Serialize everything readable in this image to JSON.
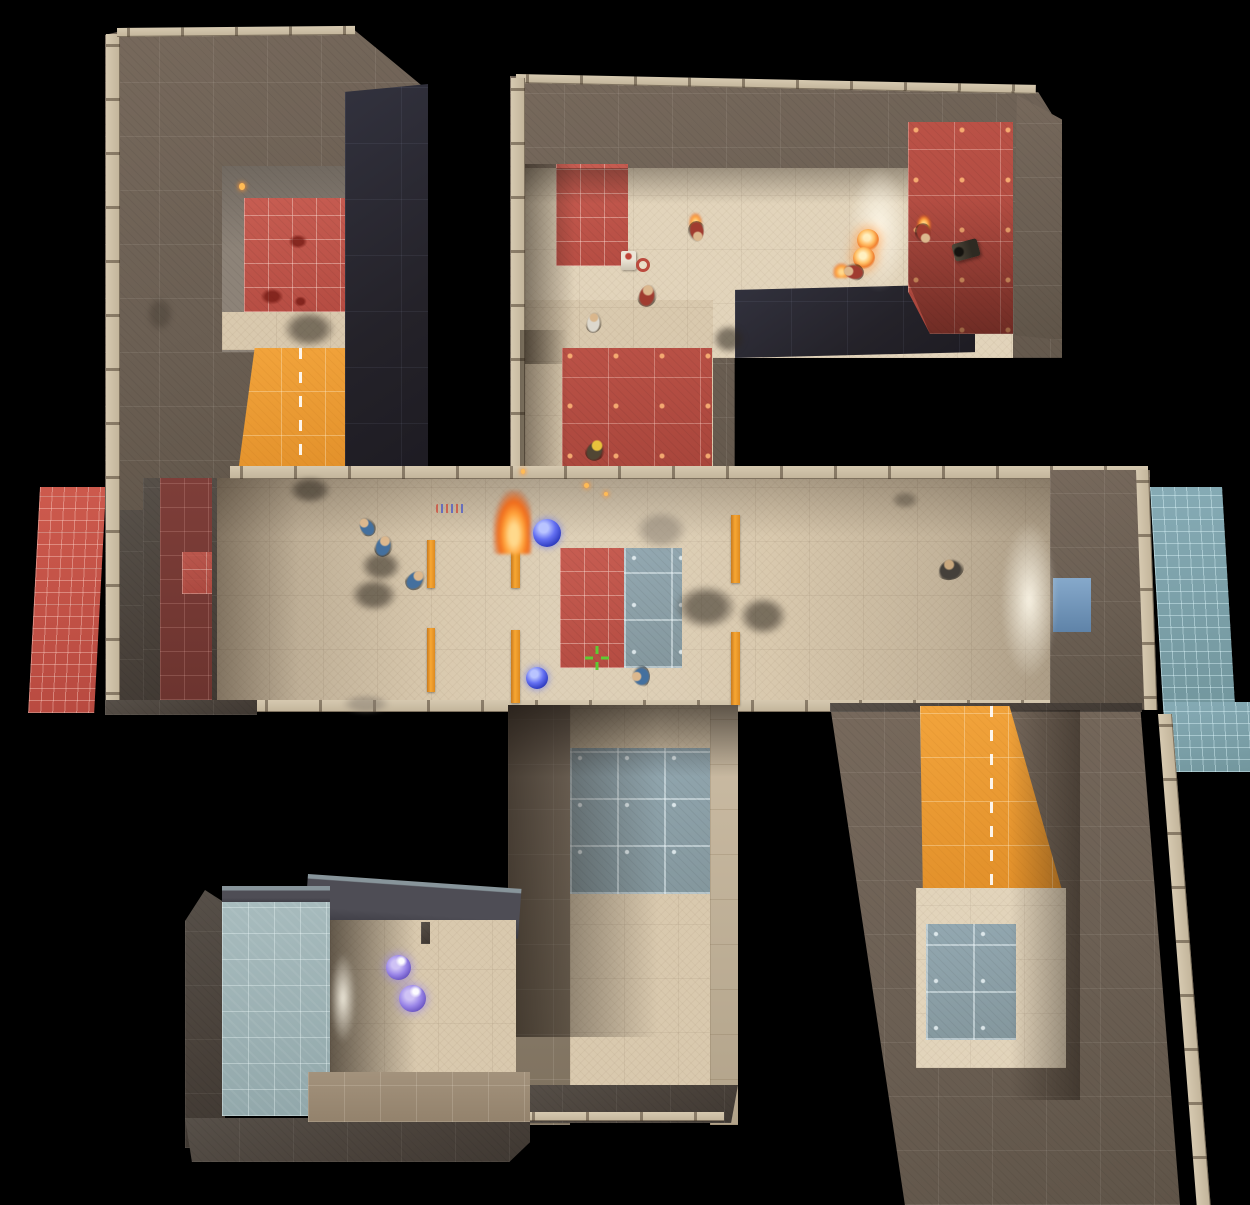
{
  "meta": {
    "width": 1250,
    "height": 1205,
    "background": "#000000",
    "scene": "top-down overhead view of four-arm pinwheel arena map with central corridor"
  },
  "palette": {
    "wall_brown": "#6e6356",
    "wall_dark": "#4c443c",
    "wall_navy": "#26242d",
    "floor_tan": "#d9c9ae",
    "red_tile": "#c05a50",
    "slate_tile": "#8da2ab",
    "blue_pad": "#7ea6b0",
    "orange_ramp": "#ec9c33",
    "crosshair_green": "#5ecb34",
    "orb_blue": "#6470f2",
    "orb_purple": "#9a86e8",
    "fireball_orange": "#ffc066"
  },
  "hud": {
    "crosshair": {
      "x": 585,
      "y": 646,
      "color": "#5ecb34"
    }
  },
  "entities": [
    {
      "name": "ext-pad-red-left",
      "cls": "tile-red-fine",
      "x": 40,
      "y": 487,
      "w": 66,
      "h": 226,
      "tr": "skewX(-3deg)"
    },
    {
      "name": "ext-pad-blue-right",
      "cls": "tile-blue-fine",
      "x": 1150,
      "y": 487,
      "w": 72,
      "h": 225,
      "tr": "skewX(3.4deg)"
    },
    {
      "name": "ext-pad-blue-right-lower",
      "cls": "tile-blue-fine",
      "x": 1163,
      "y": 702,
      "w": 90,
      "h": 70,
      "tr": "skewX(3.4deg)"
    },
    {
      "name": "topleft-arm-roof",
      "cls": "wall",
      "x": 105,
      "y": 28,
      "w": 322,
      "h": 487,
      "clip": "polygon(4% 0.8%,76.7% 0%,100% 12.7%,100% 100%,0% 100%,0% 1.4%)"
    },
    {
      "name": "topleft-arm-west-wall",
      "cls": "wall-dark",
      "x": 105,
      "y": 510,
      "w": 112,
      "h": 204,
      "clip": "polygon(0 0,100% 0,100% 94%,28% 100%,0 97%)"
    },
    {
      "name": "topleft-tick-west",
      "cls": "tickv",
      "x": 106,
      "y": 34,
      "w": 14,
      "h": 672
    },
    {
      "name": "topleft-tick-top",
      "cls": "tickh",
      "x": 117,
      "y": 28,
      "w": 238,
      "h": 9,
      "tr": "rotate(-0.5deg)"
    },
    {
      "name": "topleft-room-grey-floor",
      "cls": "floor-grey",
      "x": 222,
      "y": 166,
      "w": 123,
      "h": 186
    },
    {
      "name": "topleft-room-red-tiles",
      "cls": "tile-red-room",
      "x": 244,
      "y": 198,
      "w": 101,
      "h": 114
    },
    {
      "name": "topleft-tan-strip",
      "cls": "floor-tan",
      "x": 222,
      "y": 312,
      "w": 123,
      "h": 38
    },
    {
      "name": "topleft-orange-ramp",
      "cls": "ramp",
      "x": 237,
      "y": 348,
      "w": 126,
      "h": 132,
      "clip": "polygon(14% 0,86% 0,100% 100%,0 100%)"
    },
    {
      "name": "topleft-navy-wall",
      "cls": "wall-navy",
      "x": 345,
      "y": 84,
      "w": 83,
      "h": 396,
      "clip": "polygon(0 2%,100% 0,100% 98%,0 100%)"
    },
    {
      "name": "topright-arm-roof",
      "cls": "wall",
      "x": 510,
      "y": 70,
      "w": 552,
      "h": 402,
      "clip": "polygon(0 1.5%,95.7% 5.5%,100% 15%,100% 71.6%,40.7% 71.6%,40.7% 100%,0 100%)"
    },
    {
      "name": "topright-tick-top",
      "cls": "tickh",
      "x": 516,
      "y": 74,
      "w": 520,
      "h": 9,
      "tr": "rotate(1.2deg)"
    },
    {
      "name": "topright-tick-west",
      "cls": "tickv",
      "x": 511,
      "y": 78,
      "w": 14,
      "h": 392
    },
    {
      "name": "topright-floor-main",
      "cls": "floor-tan-bright",
      "x": 525,
      "y": 168,
      "w": 488,
      "h": 190
    },
    {
      "name": "topright-floor-leg",
      "cls": "floor-tan",
      "x": 525,
      "y": 300,
      "w": 188,
      "h": 170
    },
    {
      "name": "topright-red-wall-strip",
      "cls": "tile-red-room",
      "x": 556,
      "y": 164,
      "w": 72,
      "h": 102
    },
    {
      "name": "topright-shade-left-upper",
      "cls": "shade-v",
      "x": 525,
      "y": 164,
      "w": 50,
      "h": 200
    },
    {
      "name": "topright-red-floor-leg",
      "cls": "tile-red-big",
      "x": 562,
      "y": 348,
      "w": 150,
      "h": 122
    },
    {
      "name": "topright-shade-left-leg",
      "cls": "shade-v",
      "x": 520,
      "y": 330,
      "w": 48,
      "h": 140
    },
    {
      "name": "topright-floor-top-shade",
      "cls": "shade-top",
      "x": 525,
      "y": 168,
      "w": 488,
      "h": 36
    },
    {
      "name": "topright-navy-block",
      "cls": "wall-navy",
      "x": 735,
      "y": 284,
      "w": 240,
      "h": 74,
      "clip": "polygon(0 8%,100% 0,100% 92%,0 100%)"
    },
    {
      "name": "topright-red-room",
      "cls": "tile-red-big",
      "x": 908,
      "y": 122,
      "w": 105,
      "h": 212,
      "clip": "polygon(0 0,100% 0,100% 100%,21% 100%,0 80%)"
    },
    {
      "name": "topright-red-room-shade",
      "cls": "shade-b",
      "x": 908,
      "y": 200,
      "w": 105,
      "h": 134,
      "clip": "polygon(0 0,100% 0,100% 100%,21% 100%,0 61%)"
    },
    {
      "name": "topright-side-wall",
      "cls": "wall",
      "x": 1013,
      "y": 95,
      "w": 49,
      "h": 245,
      "clip": "polygon(8% 0,100% 10%,100% 100%,0 98%)"
    },
    {
      "name": "topright-doorway-glow",
      "cls": "glow",
      "x": 848,
      "y": 166,
      "w": 62,
      "h": 126
    },
    {
      "name": "corridor-floor",
      "cls": "floor-tan",
      "x": 215,
      "y": 478,
      "w": 840,
      "h": 226
    },
    {
      "name": "corridor-lighting",
      "cls": "shade-cor",
      "x": 215,
      "y": 478,
      "w": 840,
      "h": 226
    },
    {
      "name": "corridor-top-tick",
      "cls": "tickh",
      "x": 230,
      "y": 466,
      "w": 918,
      "h": 13
    },
    {
      "name": "corridor-west-wall",
      "cls": "wall-dark",
      "x": 143,
      "y": 478,
      "w": 74,
      "h": 226
    },
    {
      "name": "corridor-west-red-stripe",
      "cls": "tile-red-dark",
      "x": 160,
      "y": 478,
      "w": 52,
      "h": 222
    },
    {
      "name": "corridor-west-red-patch",
      "cls": "tile-red-room",
      "x": 182,
      "y": 552,
      "w": 30,
      "h": 42,
      "o": 0.85
    },
    {
      "name": "corridor-east-wall",
      "cls": "wall",
      "x": 1050,
      "y": 470,
      "w": 100,
      "h": 240,
      "clip": "polygon(0 0,100% 0,100% 100%,0 98%)"
    },
    {
      "name": "corridor-east-tick",
      "cls": "tickv",
      "x": 1136,
      "y": 470,
      "w": 13,
      "h": 240,
      "tr": "skewX(2deg)"
    },
    {
      "name": "corridor-east-blue-door",
      "cls": "door-blue",
      "x": 1053,
      "y": 578,
      "w": 38,
      "h": 54
    },
    {
      "name": "corridor-east-glow",
      "cls": "glow",
      "x": 1000,
      "y": 520,
      "w": 58,
      "h": 160
    },
    {
      "name": "corridor-bottom-tick",
      "cls": "tickh",
      "x": 255,
      "y": 700,
      "w": 795,
      "h": 12
    },
    {
      "name": "corridor-bottom-dark-left",
      "cls": "wall-dark",
      "x": 105,
      "y": 700,
      "w": 152,
      "h": 15
    },
    {
      "name": "corridor-red-square",
      "cls": "tile-red-room",
      "x": 560,
      "y": 548,
      "w": 64,
      "h": 120
    },
    {
      "name": "corridor-slate-square",
      "cls": "tile-slate",
      "x": 624,
      "y": 548,
      "w": 58,
      "h": 120
    },
    {
      "name": "door-pillar-a-upper",
      "cls": "pillar",
      "x": 427,
      "y": 540,
      "w": 8,
      "h": 48
    },
    {
      "name": "door-pillar-a-lower",
      "cls": "pillar",
      "x": 427,
      "y": 628,
      "w": 8,
      "h": 64
    },
    {
      "name": "door-pillar-b-upper",
      "cls": "pillar",
      "x": 511,
      "y": 548,
      "w": 9,
      "h": 40
    },
    {
      "name": "door-pillar-b-lower",
      "cls": "pillar",
      "x": 511,
      "y": 630,
      "w": 9,
      "h": 73
    },
    {
      "name": "door-pillar-c-upper",
      "cls": "pillar",
      "x": 731,
      "y": 515,
      "w": 9,
      "h": 68
    },
    {
      "name": "door-pillar-c-lower",
      "cls": "pillar",
      "x": 731,
      "y": 632,
      "w": 9,
      "h": 73
    },
    {
      "name": "bottommid-left-wall",
      "cls": "wall-khaki",
      "x": 508,
      "y": 705,
      "w": 62,
      "h": 420
    },
    {
      "name": "bottommid-right-wall",
      "cls": "wall-khaki-light",
      "x": 710,
      "y": 705,
      "w": 28,
      "h": 420
    },
    {
      "name": "bottommid-floor",
      "cls": "floor-tan",
      "x": 570,
      "y": 705,
      "w": 140,
      "h": 382
    },
    {
      "name": "bottommid-slate-tiles",
      "cls": "tile-slate",
      "x": 570,
      "y": 748,
      "w": 140,
      "h": 146
    },
    {
      "name": "bottommid-door-shadow",
      "cls": "shade-top-strong",
      "x": 508,
      "y": 705,
      "w": 230,
      "h": 72
    },
    {
      "name": "bottommid-left-shade",
      "cls": "shade-v-strong",
      "x": 508,
      "y": 705,
      "w": 150,
      "h": 332
    },
    {
      "name": "bottommid-bottom-wall",
      "cls": "wall-dark",
      "x": 508,
      "y": 1085,
      "w": 230,
      "h": 38,
      "clip": "polygon(0 0,100% 0,97% 100%,3% 100%)"
    },
    {
      "name": "bottommid-bottom-tick",
      "cls": "tickh",
      "x": 522,
      "y": 1112,
      "w": 202,
      "h": 9
    },
    {
      "name": "bottomleft-roof-strip",
      "cls": "roof-slate",
      "x": 308,
      "y": 874,
      "w": 214,
      "h": 50,
      "tr": "rotate(4deg)"
    },
    {
      "name": "bottomleft-left-wall",
      "cls": "wall-dark",
      "x": 185,
      "y": 890,
      "w": 40,
      "h": 258,
      "clip": "polygon(0 12%,50% 0,100% 5%,100% 100%,0 100%)"
    },
    {
      "name": "bottomleft-bottom-wall",
      "cls": "wall-dark",
      "x": 185,
      "y": 1118,
      "w": 345,
      "h": 44,
      "clip": "polygon(0 0,100% 0,100% 55%,94% 100%,2% 100%)"
    },
    {
      "name": "bottomleft-pool-top-face",
      "cls": "roof-slate",
      "x": 222,
      "y": 886,
      "w": 108,
      "h": 18
    },
    {
      "name": "bottomleft-pool-blue",
      "cls": "pool-blue",
      "x": 222,
      "y": 902,
      "w": 108,
      "h": 214
    },
    {
      "name": "bottomleft-floor",
      "cls": "floor-tan",
      "x": 330,
      "y": 920,
      "w": 186,
      "h": 158
    },
    {
      "name": "bottomleft-left-shade",
      "cls": "shade-v-strong",
      "x": 330,
      "y": 920,
      "w": 86,
      "h": 158
    },
    {
      "name": "bottomleft-door-glow",
      "cls": "glow",
      "x": 330,
      "y": 952,
      "w": 26,
      "h": 92
    },
    {
      "name": "bottomleft-tile-floor",
      "cls": "floor-tiles-brown",
      "x": 308,
      "y": 1072,
      "w": 222,
      "h": 50
    },
    {
      "name": "bottomleft-wall-stub",
      "cls": "wall-dark",
      "x": 421,
      "y": 922,
      "w": 9,
      "h": 22
    },
    {
      "name": "bottomright-arm-base",
      "cls": "wall",
      "x": 830,
      "y": 705,
      "w": 350,
      "h": 500,
      "clip": "polygon(0 0,88.6% 0,100% 100%,21.4% 100%)"
    },
    {
      "name": "bottomright-top-edge",
      "cls": "wall-dark",
      "x": 830,
      "y": 703,
      "w": 312,
      "h": 9
    },
    {
      "name": "bottomright-tick-east",
      "cls": "tickv",
      "x": 1158,
      "y": 714,
      "w": 14,
      "h": 491,
      "tr": "skewX(4.5deg)"
    },
    {
      "name": "bottomright-orange-ramp",
      "cls": "ramp",
      "x": 920,
      "y": 706,
      "w": 142,
      "h": 184,
      "clip": "polygon(0 0,63% 0,100% 100%,2% 100%)"
    },
    {
      "name": "bottomright-floor",
      "cls": "floor-tan-bright",
      "x": 916,
      "y": 888,
      "w": 150,
      "h": 180
    },
    {
      "name": "bottomright-slate-square",
      "cls": "tile-slate",
      "x": 926,
      "y": 924,
      "w": 90,
      "h": 116
    },
    {
      "name": "bottomright-right-shade",
      "cls": "shade-v-right",
      "x": 1010,
      "y": 710,
      "w": 70,
      "h": 390
    },
    {
      "name": "blood-decal-1",
      "cls": "decal-blood",
      "x": 288,
      "y": 234,
      "w": 20,
      "h": 15
    },
    {
      "name": "blood-decal-2",
      "cls": "decal-blood",
      "x": 260,
      "y": 288,
      "w": 24,
      "h": 17
    },
    {
      "name": "blood-decal-3",
      "cls": "decal-blood",
      "x": 294,
      "y": 296,
      "w": 13,
      "h": 11
    },
    {
      "name": "wall-scorch-decal",
      "cls": "smoke",
      "x": 146,
      "y": 296,
      "w": 28,
      "h": 36,
      "o": 0.5
    },
    {
      "name": "topleft-room-smoke",
      "cls": "smoke",
      "x": 282,
      "y": 310,
      "w": 54,
      "h": 38
    },
    {
      "name": "topleft-ramp-smoke",
      "cls": "smoke",
      "x": 288,
      "y": 476,
      "w": 44,
      "h": 28
    },
    {
      "name": "topleft-ember-spark",
      "cls": "ember",
      "x": 239,
      "y": 183,
      "w": 6,
      "h": 7
    },
    {
      "name": "navy-corner-smoke",
      "cls": "smoke",
      "x": 712,
      "y": 324,
      "w": 34,
      "h": 30
    },
    {
      "name": "corridor-smoke-1",
      "cls": "smoke",
      "x": 360,
      "y": 550,
      "w": 42,
      "h": 32
    },
    {
      "name": "corridor-smoke-2",
      "cls": "smoke",
      "x": 350,
      "y": 578,
      "w": 48,
      "h": 34
    },
    {
      "name": "corridor-smoke-3",
      "cls": "smoke",
      "x": 674,
      "y": 584,
      "w": 64,
      "h": 46
    },
    {
      "name": "corridor-smoke-4",
      "cls": "smoke",
      "x": 738,
      "y": 596,
      "w": 50,
      "h": 40
    },
    {
      "name": "corridor-smoke-light-1",
      "cls": "smoke-light",
      "x": 634,
      "y": 510,
      "w": 54,
      "h": 40
    },
    {
      "name": "corridor-smoke-light-2",
      "cls": "smoke-light",
      "x": 341,
      "y": 694,
      "w": 50,
      "h": 20
    },
    {
      "name": "corridor-gib-decal",
      "cls": "decal-confetti",
      "x": 436,
      "y": 504,
      "w": 30,
      "h": 9
    },
    {
      "name": "corridor-dark-decal",
      "cls": "smoke",
      "x": 891,
      "y": 491,
      "w": 28,
      "h": 18,
      "o": 0.65
    },
    {
      "name": "pillar-fire-flame",
      "cls": "fire",
      "x": 493,
      "y": 490,
      "w": 38,
      "h": 64
    },
    {
      "name": "fire-ember-1",
      "cls": "ember",
      "x": 584,
      "y": 483,
      "w": 5,
      "h": 5
    },
    {
      "name": "fire-ember-2",
      "cls": "ember",
      "x": 604,
      "y": 492,
      "w": 4,
      "h": 4
    },
    {
      "name": "fire-ember-3",
      "cls": "ember",
      "x": 521,
      "y": 469,
      "w": 4,
      "h": 5
    },
    {
      "name": "fireball-projectile-1",
      "cls": "orb-fire",
      "x": 857,
      "y": 229,
      "w": 22,
      "h": 22
    },
    {
      "name": "fireball-projectile-2",
      "cls": "orb-fire",
      "x": 853,
      "y": 247,
      "w": 22,
      "h": 22
    },
    {
      "name": "pyro-flame-trail",
      "cls": "fire-small",
      "x": 833,
      "y": 263,
      "w": 17,
      "h": 15
    },
    {
      "name": "burning-flame-1",
      "cls": "fire-small",
      "x": 917,
      "y": 215,
      "w": 14,
      "h": 17
    },
    {
      "name": "burning-flame-2",
      "cls": "fire-small",
      "x": 689,
      "y": 213,
      "w": 13,
      "h": 16
    },
    {
      "name": "blue-orb-projectile-1",
      "cls": "orb-blue",
      "x": 533,
      "y": 519,
      "w": 28,
      "h": 28
    },
    {
      "name": "blue-orb-projectile-2",
      "cls": "orb-blue",
      "x": 526,
      "y": 667,
      "w": 22,
      "h": 22
    },
    {
      "name": "purple-orb-projectile-1",
      "cls": "orb-purple",
      "x": 386,
      "y": 955,
      "w": 25,
      "h": 25
    },
    {
      "name": "purple-orb-projectile-2",
      "cls": "orb-purple",
      "x": 399,
      "y": 985,
      "w": 27,
      "h": 27
    },
    {
      "name": "player-blue-scout",
      "cls": "player p-blue",
      "x": 358,
      "y": 516,
      "w": 17,
      "h": 21,
      "tr": "rotate(-35deg)"
    },
    {
      "name": "player-blue-2",
      "cls": "player p-blue",
      "x": 374,
      "y": 534,
      "w": 19,
      "h": 23,
      "tr": "rotate(18deg)"
    },
    {
      "name": "player-blue-3",
      "cls": "player p-blue",
      "x": 406,
      "y": 568,
      "w": 19,
      "h": 23,
      "tr": "rotate(40deg)"
    },
    {
      "name": "player-soldier-corridor",
      "cls": "player p-dark",
      "x": 936,
      "y": 558,
      "w": 28,
      "h": 22,
      "tr": "rotate(-12deg)"
    },
    {
      "name": "player-blue-scout-2",
      "cls": "player p-blue",
      "x": 629,
      "y": 667,
      "w": 23,
      "h": 19,
      "tr": "rotate(-90deg)"
    },
    {
      "name": "player-red-pyro",
      "cls": "player p-red",
      "x": 844,
      "y": 261,
      "w": 18,
      "h": 22,
      "tr": "rotate(-80deg)"
    },
    {
      "name": "player-red-burning",
      "cls": "player p-red",
      "x": 915,
      "y": 223,
      "w": 18,
      "h": 22,
      "tr": "rotate(160deg)"
    },
    {
      "name": "sentry-gun",
      "cls": "sentry",
      "x": 953,
      "y": 241,
      "w": 26,
      "h": 18,
      "tr": "rotate(-15deg)"
    },
    {
      "name": "player-red-soldier-burning",
      "cls": "player p-red",
      "x": 688,
      "y": 221,
      "w": 18,
      "h": 22,
      "tr": "rotate(170deg)"
    },
    {
      "name": "dispenser",
      "cls": "dispenser",
      "x": 621,
      "y": 251,
      "w": 15,
      "h": 19
    },
    {
      "name": "dropped-item-ring",
      "cls": "ring-red",
      "x": 636,
      "y": 258,
      "w": 14,
      "h": 14
    },
    {
      "name": "player-red-heavy",
      "cls": "player p-red",
      "x": 637,
      "y": 283,
      "w": 20,
      "h": 24,
      "tr": "rotate(12deg)"
    },
    {
      "name": "player-red-medic",
      "cls": "player p-white",
      "x": 585,
      "y": 311,
      "w": 17,
      "h": 22,
      "tr": "rotate(5deg)"
    },
    {
      "name": "player-red-engineer",
      "cls": "player p-red2",
      "x": 585,
      "y": 439,
      "w": 20,
      "h": 22,
      "tr": "rotate(25deg)"
    },
    {
      "name": "hud-crosshair",
      "cls": "crosshair",
      "x": 585,
      "y": 646,
      "w": 24,
      "h": 24,
      "color": "#5ecb34"
    }
  ]
}
